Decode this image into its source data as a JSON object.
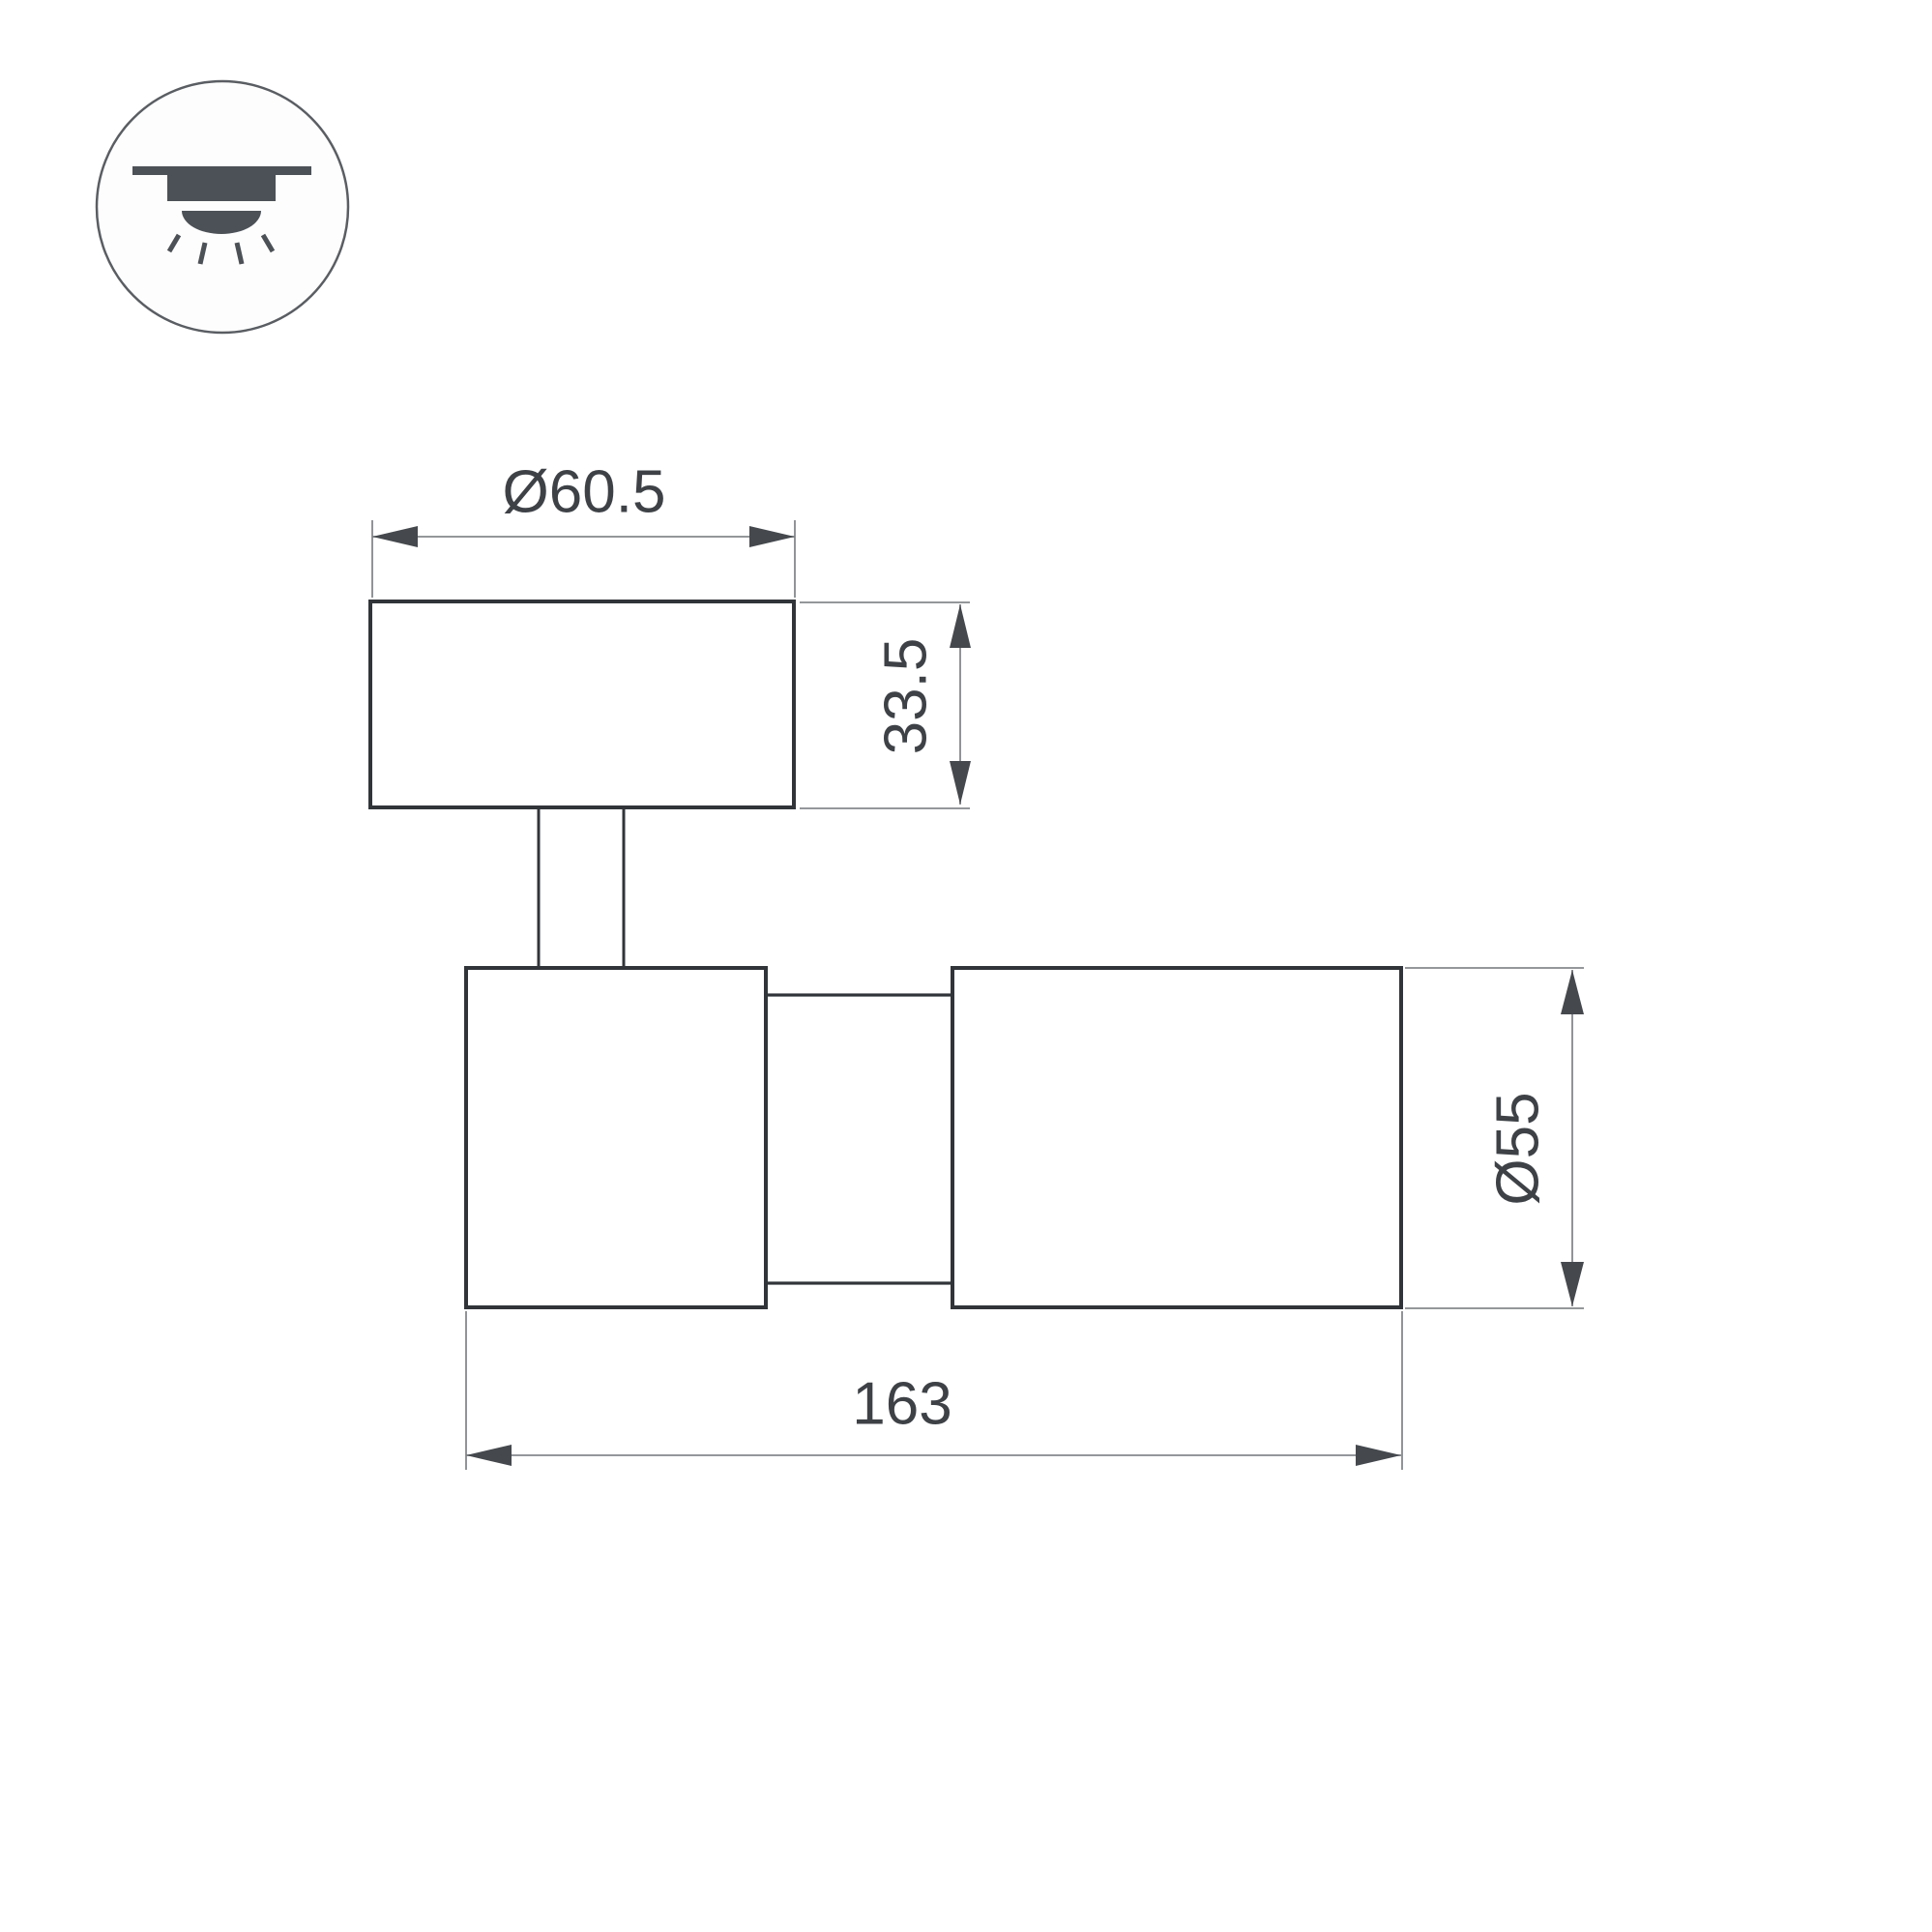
{
  "drawing": {
    "title": "spotlight-dimension-drawing",
    "dimensions": {
      "head_diameter": "Ø60.5",
      "base_height": "33.5",
      "body_diameter": "Ø55",
      "body_length": "163"
    },
    "icon": {
      "name": "surface-mounted-ceiling-light",
      "parts": [
        "ceiling-line",
        "fixture-housing",
        "light-dome",
        "light-rays"
      ]
    },
    "colors": {
      "background": "#ffffff",
      "outline": "#31353a",
      "dimension_line": "#85888b",
      "arrow": "#45494e",
      "text": "#3e4247",
      "icon_fill": "#4c5157",
      "icon_circle_stroke": "#5a5e63"
    }
  }
}
